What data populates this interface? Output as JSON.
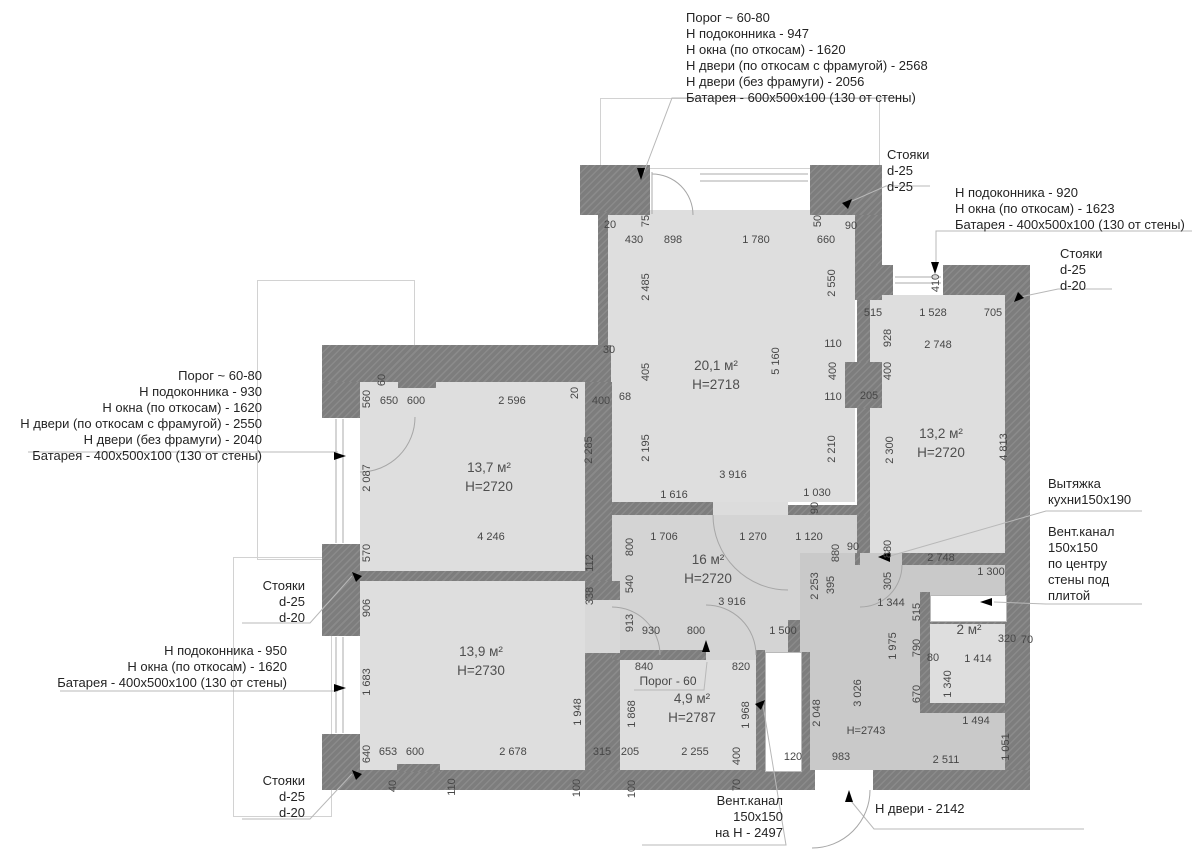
{
  "title": "Обмерный план квартиры",
  "colors": {
    "wall": "#7d7d7d",
    "room_fill": "#dedede",
    "hall_fill": "#d4d4d4",
    "entry_fill": "#c9c9c9",
    "dim_text": "#474747",
    "annotation_text": "#242424",
    "leader_line": "#b8b8b8",
    "arrow": "#000000"
  },
  "rooms": [
    {
      "area": "13,7 м²",
      "h": "Н=2720",
      "x": 489,
      "y": 468
    },
    {
      "area": "20,1 м²",
      "h": "Н=2718",
      "x": 716,
      "y": 366
    },
    {
      "area": "13,2 м²",
      "h": "Н=2720",
      "x": 941,
      "y": 434
    },
    {
      "area": "16 м²",
      "h": "Н=2720",
      "x": 708,
      "y": 560
    },
    {
      "area": "13,9 м²",
      "h": "Н=2730",
      "x": 481,
      "y": 652
    },
    {
      "area": "4,9 м²",
      "h": "Н=2787",
      "x": 692,
      "y": 699
    },
    {
      "area": "2 м²",
      "h": "",
      "x": 969,
      "y": 630
    }
  ],
  "annotations": [
    {
      "id": "spec-top",
      "x": 686,
      "y": 10,
      "align": "left",
      "lines": [
        "Порог ~ 60-80",
        "Н подоконника - 947",
        "Н окна (по откосам) - 1620",
        "Н двери (по откосам с фрамугой) - 2568",
        "Н двери (без фрамуги) - 2056",
        "Батарея - 600x500x100 (130 от стены)"
      ]
    },
    {
      "id": "risers-top-right",
      "x": 887,
      "y": 147,
      "align": "left",
      "lines": [
        "Стояки",
        "d-25",
        "d-25"
      ]
    },
    {
      "id": "spec-right",
      "x": 955,
      "y": 185,
      "align": "left",
      "lines": [
        "Н подоконника - 920",
        "Н окна (по откосам) - 1623",
        "Батарея - 400x500x100 (130 от стены)"
      ]
    },
    {
      "id": "risers-right",
      "x": 1060,
      "y": 246,
      "align": "left",
      "lines": [
        "Стояки",
        "d-25",
        "d-20"
      ]
    },
    {
      "id": "spec-left",
      "x": 262,
      "y": 368,
      "align": "right",
      "lines": [
        "Порог ~ 60-80",
        "Н подоконника - 930",
        "Н окна (по откосам) - 1620",
        "Н двери (по откосам с фрамугой) - 2550",
        "Н двери (без фрамуги) - 2040",
        "Батарея - 400x500x100 (130 от стены)"
      ]
    },
    {
      "id": "risers-left-1",
      "x": 305,
      "y": 578,
      "align": "right",
      "lines": [
        "Стояки",
        "d-25",
        "d-20"
      ]
    },
    {
      "id": "spec-left-2",
      "x": 287,
      "y": 643,
      "align": "right",
      "lines": [
        "Н подоконника - 950",
        "Н окна (по откосам) - 1620",
        "Батарея - 400x500x100 (130 от стены)"
      ]
    },
    {
      "id": "risers-left-2",
      "x": 305,
      "y": 773,
      "align": "right",
      "lines": [
        "Стояки",
        "d-25",
        "d-20"
      ]
    },
    {
      "id": "kitchen-hood",
      "x": 1048,
      "y": 476,
      "align": "left",
      "lines": [
        "Вытяжка",
        "кухни150x190"
      ]
    },
    {
      "id": "vent-duct-right",
      "x": 1048,
      "y": 524,
      "align": "left",
      "lines": [
        "Вент.канал",
        "150x150",
        "по центру",
        "стены под",
        "плитой"
      ]
    },
    {
      "id": "vent-duct-bottom",
      "x": 783,
      "y": 793,
      "align": "right",
      "lines": [
        "Вент.канал",
        "150x150",
        "на Н - 2497"
      ]
    },
    {
      "id": "door-height",
      "x": 875,
      "y": 801,
      "align": "left",
      "lines": [
        "Н двери - 2142"
      ]
    }
  ],
  "dims": [
    {
      "t": "560",
      "x": 367,
      "y": 399,
      "r": 1
    },
    {
      "t": "60",
      "x": 382,
      "y": 380,
      "r": 1
    },
    {
      "t": "650",
      "x": 389,
      "y": 401
    },
    {
      "t": "600",
      "x": 416,
      "y": 401
    },
    {
      "t": "2 596",
      "x": 512,
      "y": 401
    },
    {
      "t": "20",
      "x": 575,
      "y": 393,
      "r": 1
    },
    {
      "t": "400",
      "x": 601,
      "y": 401
    },
    {
      "t": "2 087",
      "x": 367,
      "y": 478,
      "r": 1
    },
    {
      "t": "2 285",
      "x": 589,
      "y": 450,
      "r": 1
    },
    {
      "t": "4 246",
      "x": 491,
      "y": 537
    },
    {
      "t": "570",
      "x": 367,
      "y": 553,
      "r": 1
    },
    {
      "t": "112",
      "x": 590,
      "y": 563,
      "r": 1
    },
    {
      "t": "338",
      "x": 590,
      "y": 596,
      "r": 1
    },
    {
      "t": "906",
      "x": 367,
      "y": 608,
      "r": 1
    },
    {
      "t": "1 683",
      "x": 367,
      "y": 682,
      "r": 1
    },
    {
      "t": "640",
      "x": 367,
      "y": 754,
      "r": 1
    },
    {
      "t": "653",
      "x": 388,
      "y": 752
    },
    {
      "t": "600",
      "x": 415,
      "y": 752
    },
    {
      "t": "2 678",
      "x": 513,
      "y": 752
    },
    {
      "t": "315",
      "x": 602,
      "y": 752
    },
    {
      "t": "1 948",
      "x": 578,
      "y": 712,
      "r": 1
    },
    {
      "t": "40",
      "x": 393,
      "y": 786,
      "r": 1
    },
    {
      "t": "110",
      "x": 452,
      "y": 787,
      "r": 1
    },
    {
      "t": "100",
      "x": 577,
      "y": 788,
      "r": 1
    },
    {
      "t": "20",
      "x": 610,
      "y": 225
    },
    {
      "t": "75",
      "x": 646,
      "y": 221,
      "r": 1
    },
    {
      "t": "430",
      "x": 634,
      "y": 240
    },
    {
      "t": "898",
      "x": 673,
      "y": 240
    },
    {
      "t": "1 780",
      "x": 756,
      "y": 240
    },
    {
      "t": "50",
      "x": 818,
      "y": 221,
      "r": 1
    },
    {
      "t": "660",
      "x": 826,
      "y": 240
    },
    {
      "t": "90",
      "x": 851,
      "y": 226
    },
    {
      "t": "2 485",
      "x": 646,
      "y": 287,
      "r": 1
    },
    {
      "t": "2 550",
      "x": 832,
      "y": 283,
      "r": 1
    },
    {
      "t": "30",
      "x": 609,
      "y": 350
    },
    {
      "t": "405",
      "x": 646,
      "y": 372,
      "r": 1
    },
    {
      "t": "68",
      "x": 625,
      "y": 397
    },
    {
      "t": "2 195",
      "x": 646,
      "y": 448,
      "r": 1
    },
    {
      "t": "5 160",
      "x": 776,
      "y": 361,
      "r": 1
    },
    {
      "t": "110",
      "x": 833,
      "y": 344
    },
    {
      "t": "400",
      "x": 833,
      "y": 371,
      "r": 1
    },
    {
      "t": "110",
      "x": 833,
      "y": 397
    },
    {
      "t": "205",
      "x": 869,
      "y": 396
    },
    {
      "t": "2 210",
      "x": 832,
      "y": 449,
      "r": 1
    },
    {
      "t": "3 916",
      "x": 733,
      "y": 475
    },
    {
      "t": "1 616",
      "x": 674,
      "y": 495
    },
    {
      "t": "1 030",
      "x": 817,
      "y": 493
    },
    {
      "t": "90",
      "x": 815,
      "y": 508,
      "r": 1
    },
    {
      "t": "410",
      "x": 936,
      "y": 283,
      "r": 1
    },
    {
      "t": "515",
      "x": 873,
      "y": 313
    },
    {
      "t": "1 528",
      "x": 933,
      "y": 313
    },
    {
      "t": "705",
      "x": 993,
      "y": 313
    },
    {
      "t": "928",
      "x": 888,
      "y": 338,
      "r": 1
    },
    {
      "t": "2 748",
      "x": 938,
      "y": 345
    },
    {
      "t": "400",
      "x": 888,
      "y": 371,
      "r": 1
    },
    {
      "t": "2 300",
      "x": 890,
      "y": 450,
      "r": 1
    },
    {
      "t": "4 813",
      "x": 1004,
      "y": 447,
      "r": 1
    },
    {
      "t": "880",
      "x": 888,
      "y": 549,
      "r": 1
    },
    {
      "t": "90",
      "x": 853,
      "y": 547
    },
    {
      "t": "2 748",
      "x": 941,
      "y": 558
    },
    {
      "t": "305",
      "x": 888,
      "y": 581,
      "r": 1
    },
    {
      "t": "1 300",
      "x": 991,
      "y": 572
    },
    {
      "t": "1 706",
      "x": 664,
      "y": 537
    },
    {
      "t": "1 270",
      "x": 753,
      "y": 537
    },
    {
      "t": "1 120",
      "x": 809,
      "y": 537
    },
    {
      "t": "800",
      "x": 630,
      "y": 547,
      "r": 1
    },
    {
      "t": "880",
      "x": 836,
      "y": 553,
      "r": 1
    },
    {
      "t": "540",
      "x": 630,
      "y": 584,
      "r": 1
    },
    {
      "t": "2 253",
      "x": 815,
      "y": 586,
      "r": 1
    },
    {
      "t": "395",
      "x": 831,
      "y": 585,
      "r": 1
    },
    {
      "t": "3 916",
      "x": 732,
      "y": 602
    },
    {
      "t": "913",
      "x": 630,
      "y": 623,
      "r": 1
    },
    {
      "t": "930",
      "x": 651,
      "y": 631
    },
    {
      "t": "800",
      "x": 696,
      "y": 631
    },
    {
      "t": "1 500",
      "x": 783,
      "y": 631
    },
    {
      "t": "1 344",
      "x": 891,
      "y": 603
    },
    {
      "t": "515",
      "x": 917,
      "y": 612,
      "r": 1
    },
    {
      "t": "1 975",
      "x": 893,
      "y": 646,
      "r": 1
    },
    {
      "t": "790",
      "x": 917,
      "y": 648,
      "r": 1
    },
    {
      "t": "80",
      "x": 933,
      "y": 658
    },
    {
      "t": "320",
      "x": 1007,
      "y": 639
    },
    {
      "t": "70",
      "x": 1027,
      "y": 640
    },
    {
      "t": "1 414",
      "x": 978,
      "y": 659
    },
    {
      "t": "1 340",
      "x": 948,
      "y": 684,
      "r": 1
    },
    {
      "t": "670",
      "x": 917,
      "y": 694,
      "r": 1
    },
    {
      "t": "3 026",
      "x": 858,
      "y": 693,
      "r": 1
    },
    {
      "t": "2 048",
      "x": 817,
      "y": 713,
      "r": 1
    },
    {
      "t": "Н=2743",
      "x": 866,
      "y": 731
    },
    {
      "t": "983",
      "x": 841,
      "y": 757
    },
    {
      "t": "1 494",
      "x": 976,
      "y": 721
    },
    {
      "t": "2 511",
      "x": 946,
      "y": 760
    },
    {
      "t": "1 051",
      "x": 1006,
      "y": 747,
      "r": 1
    },
    {
      "t": "840",
      "x": 644,
      "y": 667
    },
    {
      "t": "820",
      "x": 741,
      "y": 667
    },
    {
      "t": "Порог - 60",
      "x": 668,
      "y": 681,
      "porog": 1
    },
    {
      "t": "1 868",
      "x": 632,
      "y": 714,
      "r": 1
    },
    {
      "t": "1 968",
      "x": 746,
      "y": 715,
      "r": 1
    },
    {
      "t": "205",
      "x": 630,
      "y": 752
    },
    {
      "t": "2 255",
      "x": 695,
      "y": 752
    },
    {
      "t": "400",
      "x": 737,
      "y": 756,
      "r": 1
    },
    {
      "t": "120",
      "x": 793,
      "y": 757
    },
    {
      "t": "70",
      "x": 737,
      "y": 785,
      "r": 1
    },
    {
      "t": "100",
      "x": 632,
      "y": 789,
      "r": 1
    }
  ]
}
